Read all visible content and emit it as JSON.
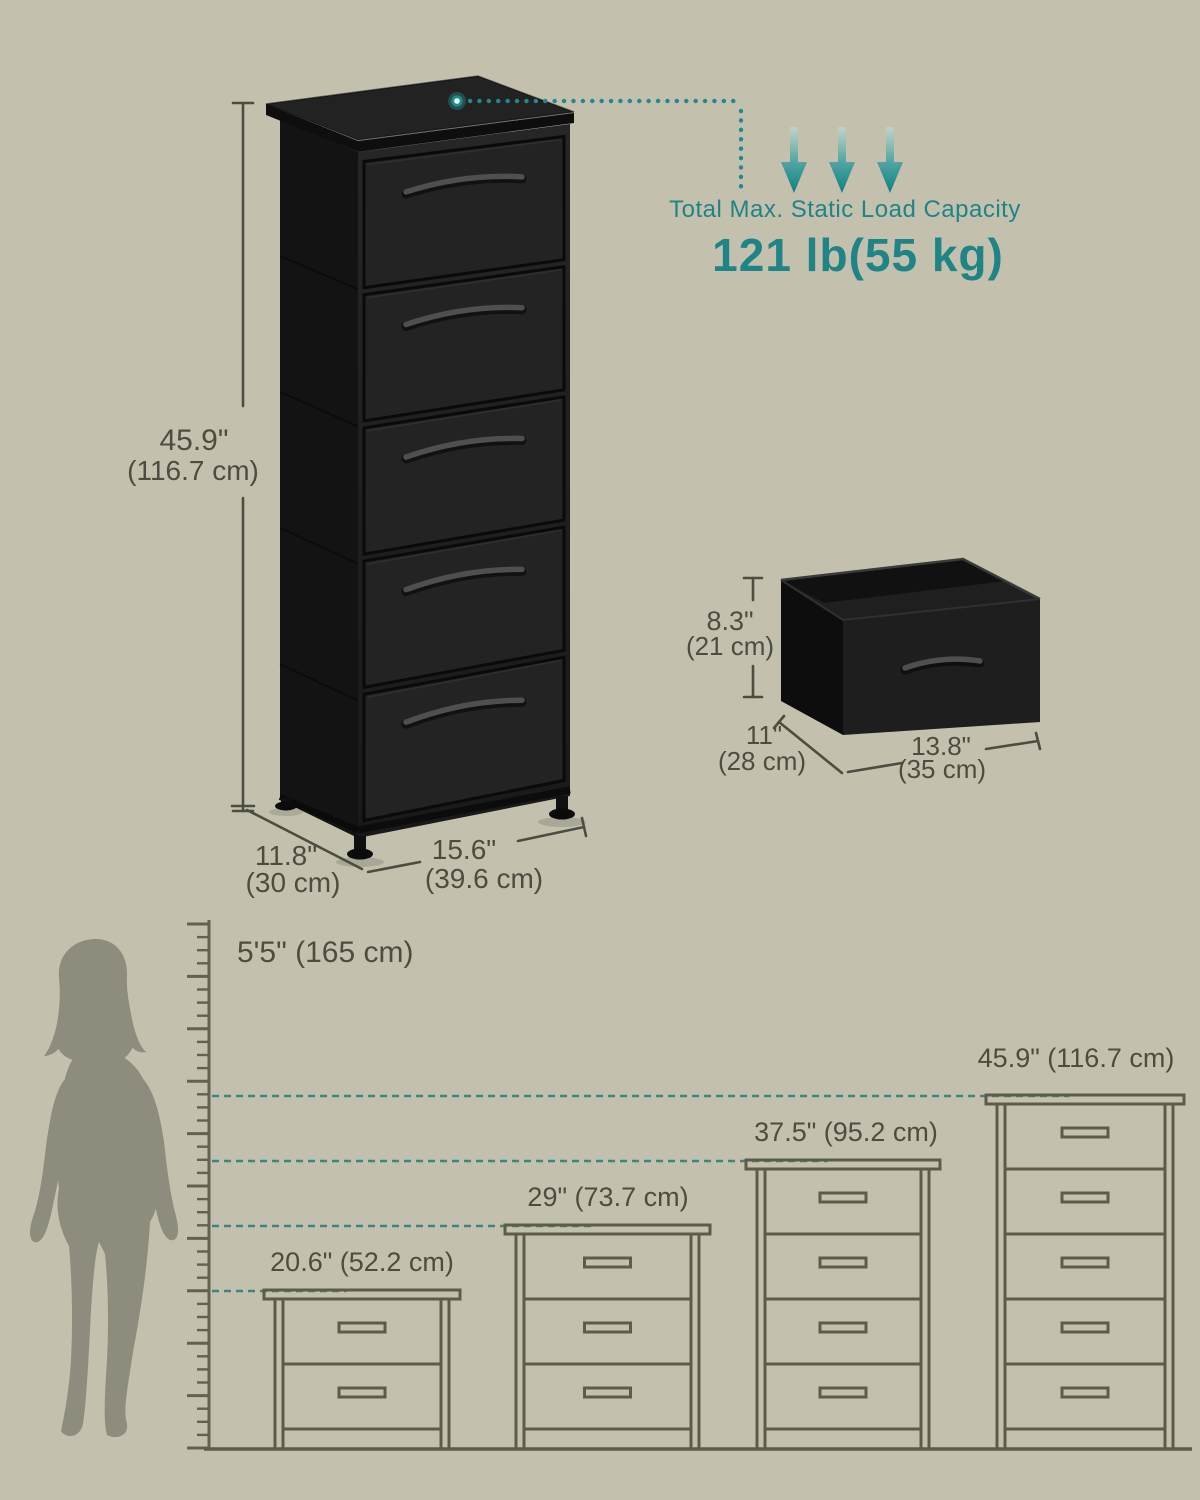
{
  "colors": {
    "background": "#c3c1ae",
    "accent_teal": "#1f8486",
    "teal_dash": "#3d867f",
    "outline_line": "#5d5c4b",
    "dimension_text": "#4d4c41",
    "silhouette": "#8e8d7d",
    "product_black": "#1c1c1c"
  },
  "main_product": {
    "drawer_count": 5
  },
  "main_dimensions": {
    "height_in": "45.9\"",
    "height_cm": "(116.7 cm)",
    "depth_in": "11.8\"",
    "depth_cm": "(30 cm)",
    "width_in": "15.6\"",
    "width_cm": "(39.6 cm)"
  },
  "load_capacity": {
    "label": "Total Max. Static Load Capacity",
    "value": "121 lb(55 kg)"
  },
  "drawer_dimensions": {
    "height_in": "8.3\"",
    "height_cm": "(21 cm)",
    "depth_in": "11\"",
    "depth_cm": "(28 cm)",
    "width_in": "13.8\"",
    "width_cm": "(35 cm)"
  },
  "size_comparison": {
    "person_height": "5'5\" (165 cm)",
    "variants": [
      {
        "label": "20.6\" (52.2 cm)",
        "drawer_count": 2
      },
      {
        "label": "29\" (73.7 cm)",
        "drawer_count": 3
      },
      {
        "label": "37.5\" (95.2 cm)",
        "drawer_count": 4
      },
      {
        "label": "45.9\" (116.7 cm)",
        "drawer_count": 5
      }
    ]
  }
}
